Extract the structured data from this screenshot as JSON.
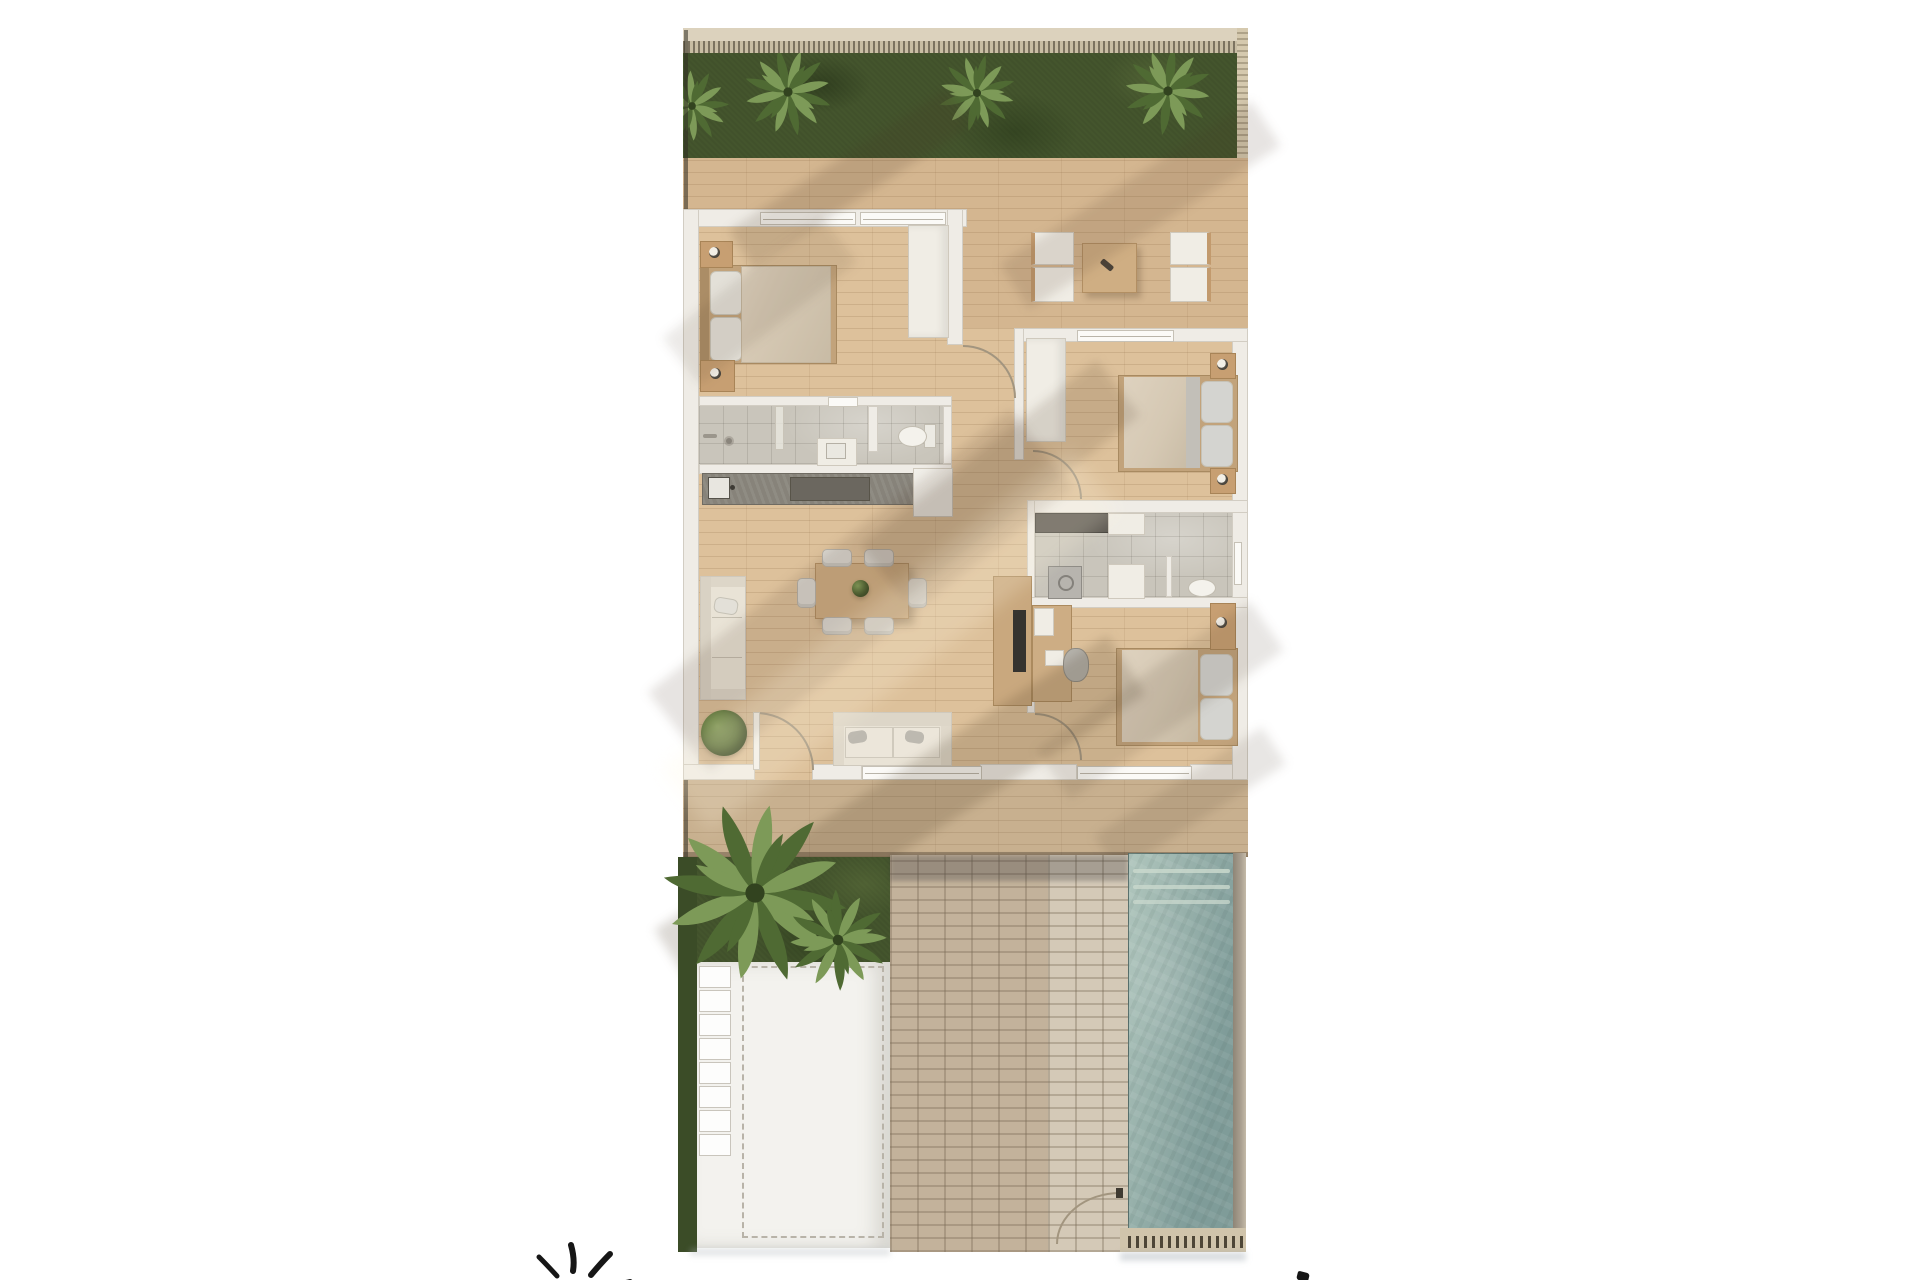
{
  "scene": {
    "type": "floor-plan-3d-render",
    "description": "Top-down 3D render of a three-bedroom villa: hedge and palm garden on top, wooden deck with outdoor lounge, interior with master bedroom, two bathrooms, kitchen, living-dining area, two further bedrooms, and at the bottom a terrace deck, lawn, white driveway, brick path, gate and swimming pool",
    "rooms": [
      "garden",
      "deck-terrace",
      "outdoor-lounge",
      "master-bedroom",
      "hallway-entry",
      "bedroom-2",
      "bathroom-1",
      "bathroom-2",
      "kitchen",
      "living-dining",
      "bedroom-3",
      "terrace-deck",
      "lawn",
      "driveway",
      "brick-path",
      "pool"
    ]
  },
  "icons": {
    "sun_logo": "hand-drawn sun with spiral core and radiating rays, bottom-left watermark, cropped by image edge",
    "cropped_mark": "small black stroke cropped at the bottom-right image edge"
  },
  "palette": {
    "page_bg": "#ffffff",
    "wood_interior": "#ddc19b",
    "deck_tint": "rgba(146,108,62,0.12)",
    "bottom_deck_tint": "rgba(108,98,86,0.18)",
    "wall": "#efece6",
    "wall_edge": "#d2cdc3",
    "window_white": "#fbfaf7",
    "fascia": "#dcd2bd",
    "fence_base": "#c8bda3",
    "fence_tick": "rgba(62,54,40,0.55)",
    "garden_green": "#44552d",
    "grass_dark": "#3b4c27",
    "palm_dark": "#4f6a33",
    "palm_light": "#7d9a58",
    "bath_floor": "#c9c5bb",
    "tile_line": "rgba(70,65,55,0.14)",
    "counter_dark": "#87837a",
    "stove_dark": "#6b675f",
    "cabinet_white": "#f2f0ea",
    "furniture_white": "#f0ede5",
    "furniture_border": "#cfc9bd",
    "sofa_cream": "#e9e3d6",
    "cushion_gray": "#bdb9b0",
    "bed_duvet": "#d5c8b3",
    "bed_pillow": "#e3e0d8",
    "bed_frame": "#c2a37b",
    "nightstand_wood": "#c79f72",
    "table_wood": "#cfae83",
    "table_wood_border": "#b28f63",
    "door_arc": "#a2957f",
    "pool_light": "#b0c6bd",
    "pool_dark": "#7f9c99",
    "pool_step": "#c9d8cd",
    "pool_coping": "#d0c4ab",
    "pool_wall": "#a99f90",
    "brick_dark": "#c3b29b",
    "brick_light": "#d4c9b7",
    "mortar": "rgba(120,105,85,0.35)",
    "driveway": "#f3f2ee",
    "dash_line": "#b8b3a8",
    "paver_white": "#fdfdfc",
    "edge_dark": "rgba(50,45,35,0.55)",
    "logo_black": "#161616"
  }
}
